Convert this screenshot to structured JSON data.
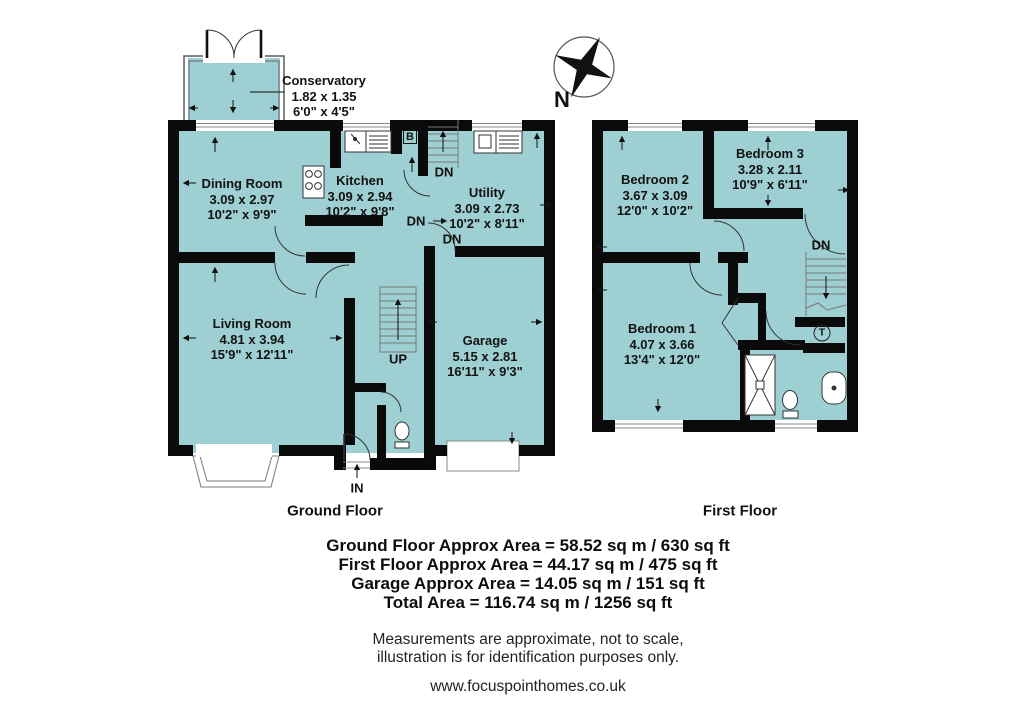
{
  "palette": {
    "room_fill": "#9ECFD2",
    "wall": "#0a0a0a",
    "thin_line": "#555555",
    "text": "#121212"
  },
  "compass": {
    "north_label": "N"
  },
  "ground_floor": {
    "title": "Ground Floor",
    "rooms": {
      "conservatory": {
        "name": "Conservatory",
        "metric": "1.82 x 1.35",
        "imperial": "6'0\" x 4'5\""
      },
      "dining": {
        "name": "Dining Room",
        "metric": "3.09 x 2.97",
        "imperial": "10'2\" x 9'9\""
      },
      "kitchen": {
        "name": "Kitchen",
        "metric": "3.09 x 2.94",
        "imperial": "10'2\" x 9'8\""
      },
      "utility": {
        "name": "Utility",
        "metric": "3.09 x 2.73",
        "imperial": "10'2\" x 8'11\""
      },
      "living": {
        "name": "Living Room",
        "metric": "4.81 x 3.94",
        "imperial": "15'9\" x 12'11\""
      },
      "garage": {
        "name": "Garage",
        "metric": "5.15 x 2.81",
        "imperial": "16'11\" x 9'3\""
      }
    },
    "markers": {
      "dn": "DN",
      "up": "UP",
      "entrance": "IN",
      "boiler": "B"
    }
  },
  "first_floor": {
    "title": "First Floor",
    "rooms": {
      "bedroom1": {
        "name": "Bedroom 1",
        "metric": "4.07 x 3.66",
        "imperial": "13'4\" x 12'0\""
      },
      "bedroom2": {
        "name": "Bedroom 2",
        "metric": "3.67 x 3.09",
        "imperial": "12'0\" x 10'2\""
      },
      "bedroom3": {
        "name": "Bedroom 3",
        "metric": "3.28 x 2.11",
        "imperial": "10'9\" x 6'11\""
      }
    },
    "markers": {
      "dn": "DN",
      "tank": "T"
    }
  },
  "areas": {
    "ground": "Ground Floor Approx Area = 58.52 sq m / 630 sq ft",
    "first": "First Floor Approx Area = 44.17 sq m / 475 sq ft",
    "garage": "Garage Approx Area = 14.05 sq m / 151 sq ft",
    "total": "Total Area = 116.74 sq m / 1256 sq ft"
  },
  "disclaimer": {
    "line1": "Measurements are approximate, not to scale,",
    "line2": "illustration is for identification purposes only."
  },
  "website": "www.focuspointhomes.co.uk"
}
